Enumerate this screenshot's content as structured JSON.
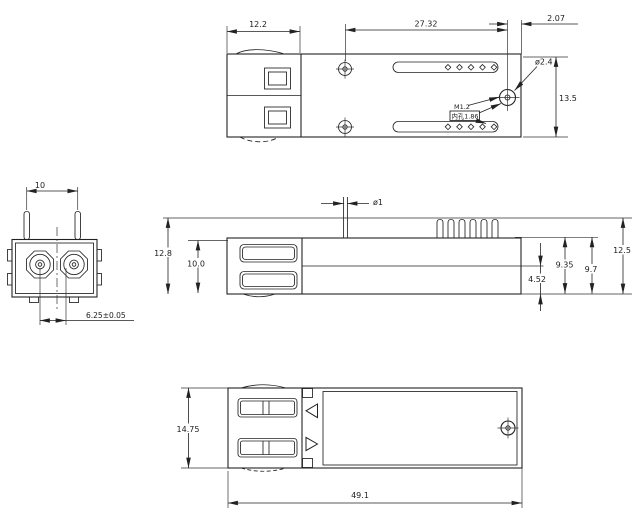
{
  "views": {
    "top": {
      "dims": {
        "latch_length": "12.2",
        "hole_span": "27.32",
        "screw_to_edge": "2.07",
        "screw_head_dia": "ø2.4",
        "body_width": "13.5",
        "thread_size": "M1.2",
        "inner_hole_note": "内孔1.86"
      }
    },
    "front": {
      "dims": {
        "pin_pitch": "10",
        "fiber_pitch": "6.25±0.05"
      }
    },
    "side": {
      "dims": {
        "overall_height": "12.8",
        "front_height": "10.0",
        "pin_dia": "ø1",
        "base_height": "4.52",
        "rear_height_a": "9.35",
        "rear_height_b": "9.7",
        "total_height": "12.5"
      }
    },
    "bottom": {
      "dims": {
        "body_width": "14.75",
        "overall_length": "49.1"
      }
    }
  }
}
